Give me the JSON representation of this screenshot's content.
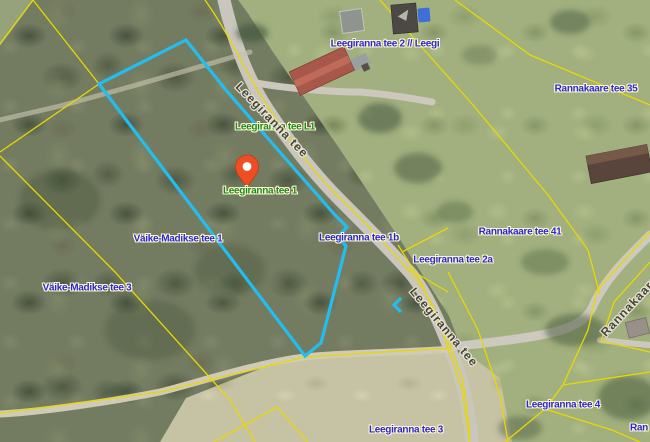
{
  "map": {
    "labels": {
      "blue": [
        {
          "text": "Leegiranna tee 2 // Leegi"
        },
        {
          "text": "Väike-Madikse tee 1"
        },
        {
          "text": "Väike-Madikse tee 3"
        },
        {
          "text": "Leegiranna tee 1b"
        },
        {
          "text": "Leegiranna tee 2a"
        },
        {
          "text": "Rannakaare tee 41"
        },
        {
          "text": "Rannakaare tee 35"
        },
        {
          "text": "Leegiranna tee 4"
        },
        {
          "text": "Leegiranna tee 3"
        },
        {
          "text": "Ran"
        }
      ],
      "green": [
        {
          "text": "Leegiranna tee L1"
        },
        {
          "text": "Leegiranna tee 1"
        }
      ],
      "road": [
        {
          "text": "Leegiranna tee"
        },
        {
          "text": "Leegiranna tee"
        },
        {
          "text": "Rannakaare tee"
        }
      ]
    },
    "colors": {
      "selected_parcel": "#23bdf0",
      "cadastral_boundary": "#e8d800",
      "marker": "#ee4e23",
      "label_blue": "#2929d6",
      "label_green": "#1f8a1f"
    }
  }
}
